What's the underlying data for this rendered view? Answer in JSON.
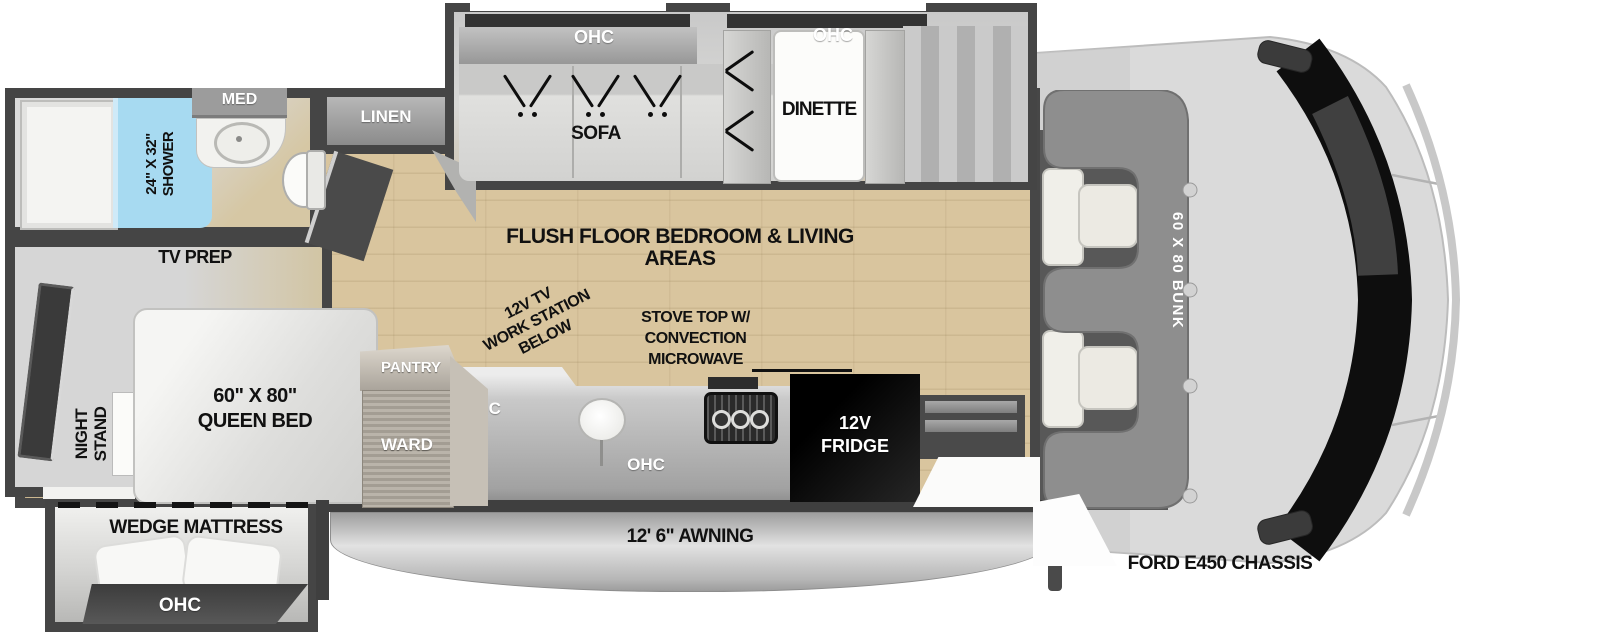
{
  "floorplan": {
    "chassis_label": "FORD E450 CHASSIS",
    "awning_label": "12' 6\" AWNING",
    "main_area_label": "FLUSH FLOOR BEDROOM & LIVING AREAS",
    "bunk_label": "60 X 80 BUNK",
    "bathroom": {
      "shower_size": "24\" X 32\"",
      "shower_word": "SHOWER",
      "med": "MED",
      "linen": "LINEN",
      "tv_prep": "TV PREP"
    },
    "living": {
      "ohc": "OHC",
      "sofa": "SOFA",
      "dinette": "DINETTE"
    },
    "kitchen": {
      "ohc": "OHC",
      "pantry": "PANTRY",
      "ward": "WARD",
      "fridge_line1": "12V",
      "fridge_line2": "FRIDGE",
      "stove_line1": "STOVE TOP W/",
      "stove_line2": "CONVECTION",
      "stove_line3": "MICROWAVE",
      "workstation_line1": "12V TV",
      "workstation_line2": "WORK STATION",
      "workstation_line3": "BELOW"
    },
    "bedroom": {
      "night_line1": "NIGHT",
      "night_line2": "STAND",
      "bed_line1": "60\" X 80\"",
      "bed_line2": "QUEEN BED",
      "wedge": "WEDGE MATTRESS",
      "ohc": "OHC"
    },
    "colors": {
      "wall": "#474747",
      "wood_floor": "#d9c59e",
      "slide_gray": "#d6d6d6",
      "shower_blue": "#a7daf1",
      "bunk_gray": "#8e8e8e",
      "fridge_black": "#0d0d0d",
      "cab_gray": "#dadada",
      "windshield_black": "#0e0e0e"
    }
  }
}
